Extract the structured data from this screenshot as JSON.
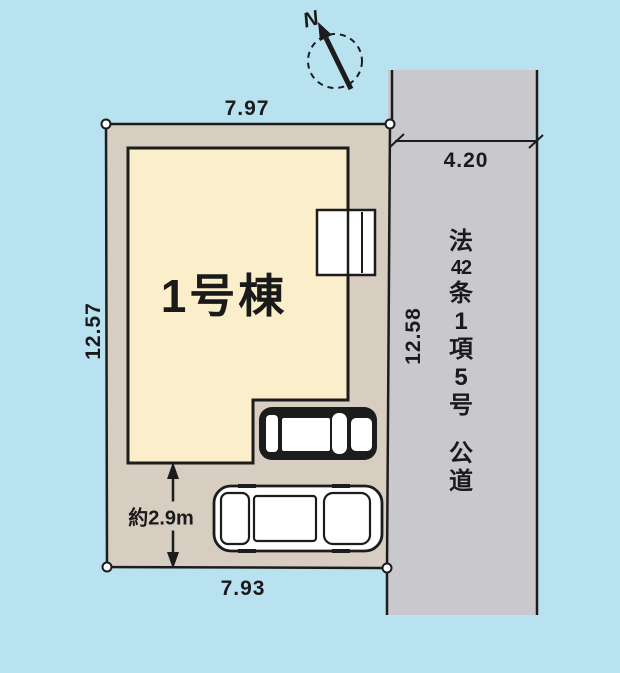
{
  "diagram": {
    "title": "site-plan",
    "building_label": "1号棟",
    "compass_label": "N",
    "road_label": "法42条1項5号 公道",
    "road_label_chars": [
      "法",
      "42",
      "条",
      "1",
      "項",
      "5",
      "号",
      "公",
      "道"
    ],
    "dimensions": {
      "top_width": "7.97",
      "bottom_width": "7.93",
      "left_depth": "12.57",
      "right_depth": "12.58",
      "road_width": "4.20",
      "parking_depth": "約2.9m"
    },
    "colors": {
      "background": "#b9e2f1",
      "road_fill": "#c9c9cd",
      "lot_fill": "#d8cdc1",
      "building_fill": "#fbeeca",
      "line": "#1c1c1c",
      "text": "#1a1a1a"
    }
  }
}
